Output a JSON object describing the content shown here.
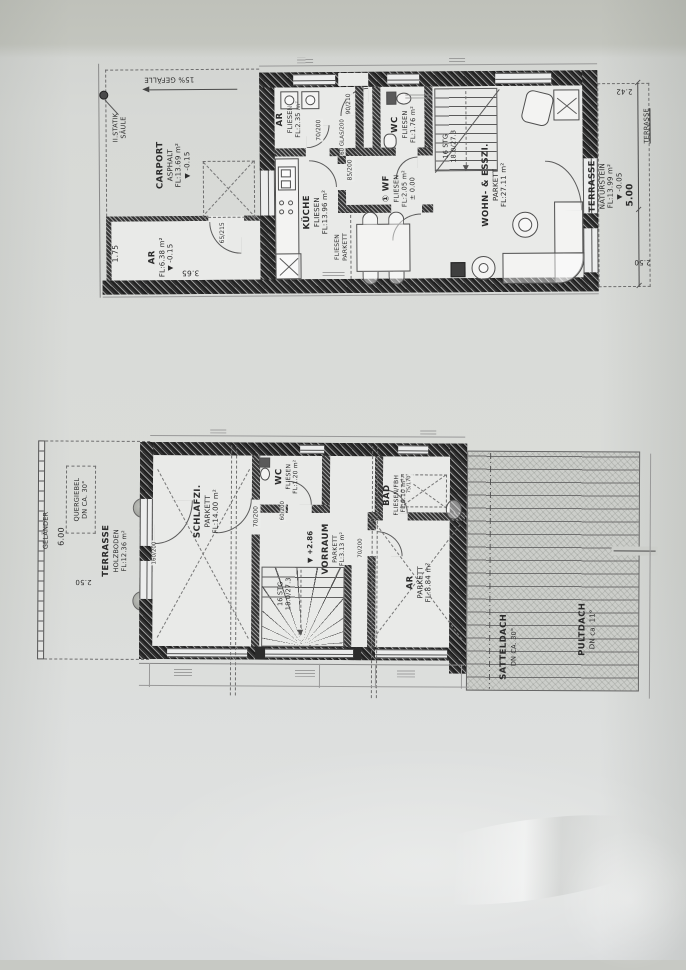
{
  "photo": {
    "paper_color": "#d9dbd8",
    "shadow_color": "#c2c4bd",
    "ink_color": "#2f2f2f"
  },
  "ground_floor": {
    "carport": {
      "title": "CARPORT",
      "l2": "ASPHALT",
      "l3": "FL:13.69 m²",
      "l4": "▼ -0.15"
    },
    "slope_note": "15% GEFÄLLE",
    "statik": {
      "l1": "II.STATIK",
      "l2": "SÄULE"
    },
    "ar_out": {
      "title": "AR",
      "l2": "FL:6.38 m²",
      "l3": "▼ -0.15"
    },
    "ar": {
      "title": "AR",
      "l2": "FLIESEN",
      "l3": "FL:2.35 m²"
    },
    "kueche": {
      "title": "KÜCHE",
      "l2": "FLIESEN",
      "l3": "FL:13.96 m²"
    },
    "wc": {
      "title": "WC",
      "l2": "FLIESEN",
      "l3": "FL:1.76 m²"
    },
    "wf": {
      "title": "① WF",
      "l2": "FLIESEN",
      "l3": "FL:2.05 m²",
      "l4": "± 0.00"
    },
    "wohnen": {
      "title": "WOHN- & ESSZI.",
      "l2": "PARKETT",
      "l3": "FL:27.11 m²"
    },
    "terrasse": {
      "title": "TERRASSE",
      "l2": "NATURSTEIN",
      "l3": "FL:13.99 m²",
      "l4": "▼ -0.05"
    },
    "terrasse_tag": "TERRASSE",
    "stairs": {
      "l1": "16 STG",
      "l2": "18.0/27.3"
    },
    "floor_split": {
      "l1": "FLIESEN",
      "l2": "PARKETT"
    },
    "doors": {
      "entry": "90/210",
      "ar": "70/200",
      "kueche": "60 GLAS/200",
      "wohnen": "85/200",
      "ar_out": "65/215"
    },
    "dims": {
      "ar_w": "1.75",
      "ar_l": "3.65",
      "terr_top": "2.42",
      "terr_len": "5.00",
      "terr_bot": "2.50"
    }
  },
  "upper_floor": {
    "gelaender": "GELÄNDER",
    "quergiebel": {
      "l1": "QUERGIEBEL",
      "l2": "DN CA. 30°"
    },
    "terrasse": {
      "title": "TERRASSE",
      "l2": "HOLZBODEN",
      "l3": "FL:12.36 m²"
    },
    "schlafzi": {
      "title": "SCHLAFZI.",
      "l2": "PARKETT",
      "l3": "FL:14.00 m²"
    },
    "wc": {
      "title": "WC",
      "l2": "FLIESEN",
      "l3": "FL:1.20 m²"
    },
    "vorraum": {
      "title": "VORRAUM",
      "l2": "PARKETT",
      "l3": "FL:3.13 m²"
    },
    "vorraum_level": "▼ +2.86",
    "bad": {
      "title": "BAD",
      "l2": "FLIESEN/FBH",
      "l3": "FL:6.10 m²"
    },
    "ar": {
      "title": "AR",
      "l2": "PARKETT",
      "l3": "FL:8.84 m²"
    },
    "stairs": {
      "l1": "16 STG",
      "l2": "18.0/27.3"
    },
    "pultdach": {
      "l1": "PULTDACH",
      "l2": "DN ca. 11°"
    },
    "satteldach": {
      "l1": "SATTELDACH",
      "l2": "DN CA. 30°"
    },
    "tub": "75/170",
    "doors": {
      "schlafzi": "70/200",
      "wc": "60/200",
      "ar": "70/200",
      "terrasse": "160/200"
    },
    "dims": {
      "len": "6.00",
      "wid": "2.50"
    }
  }
}
